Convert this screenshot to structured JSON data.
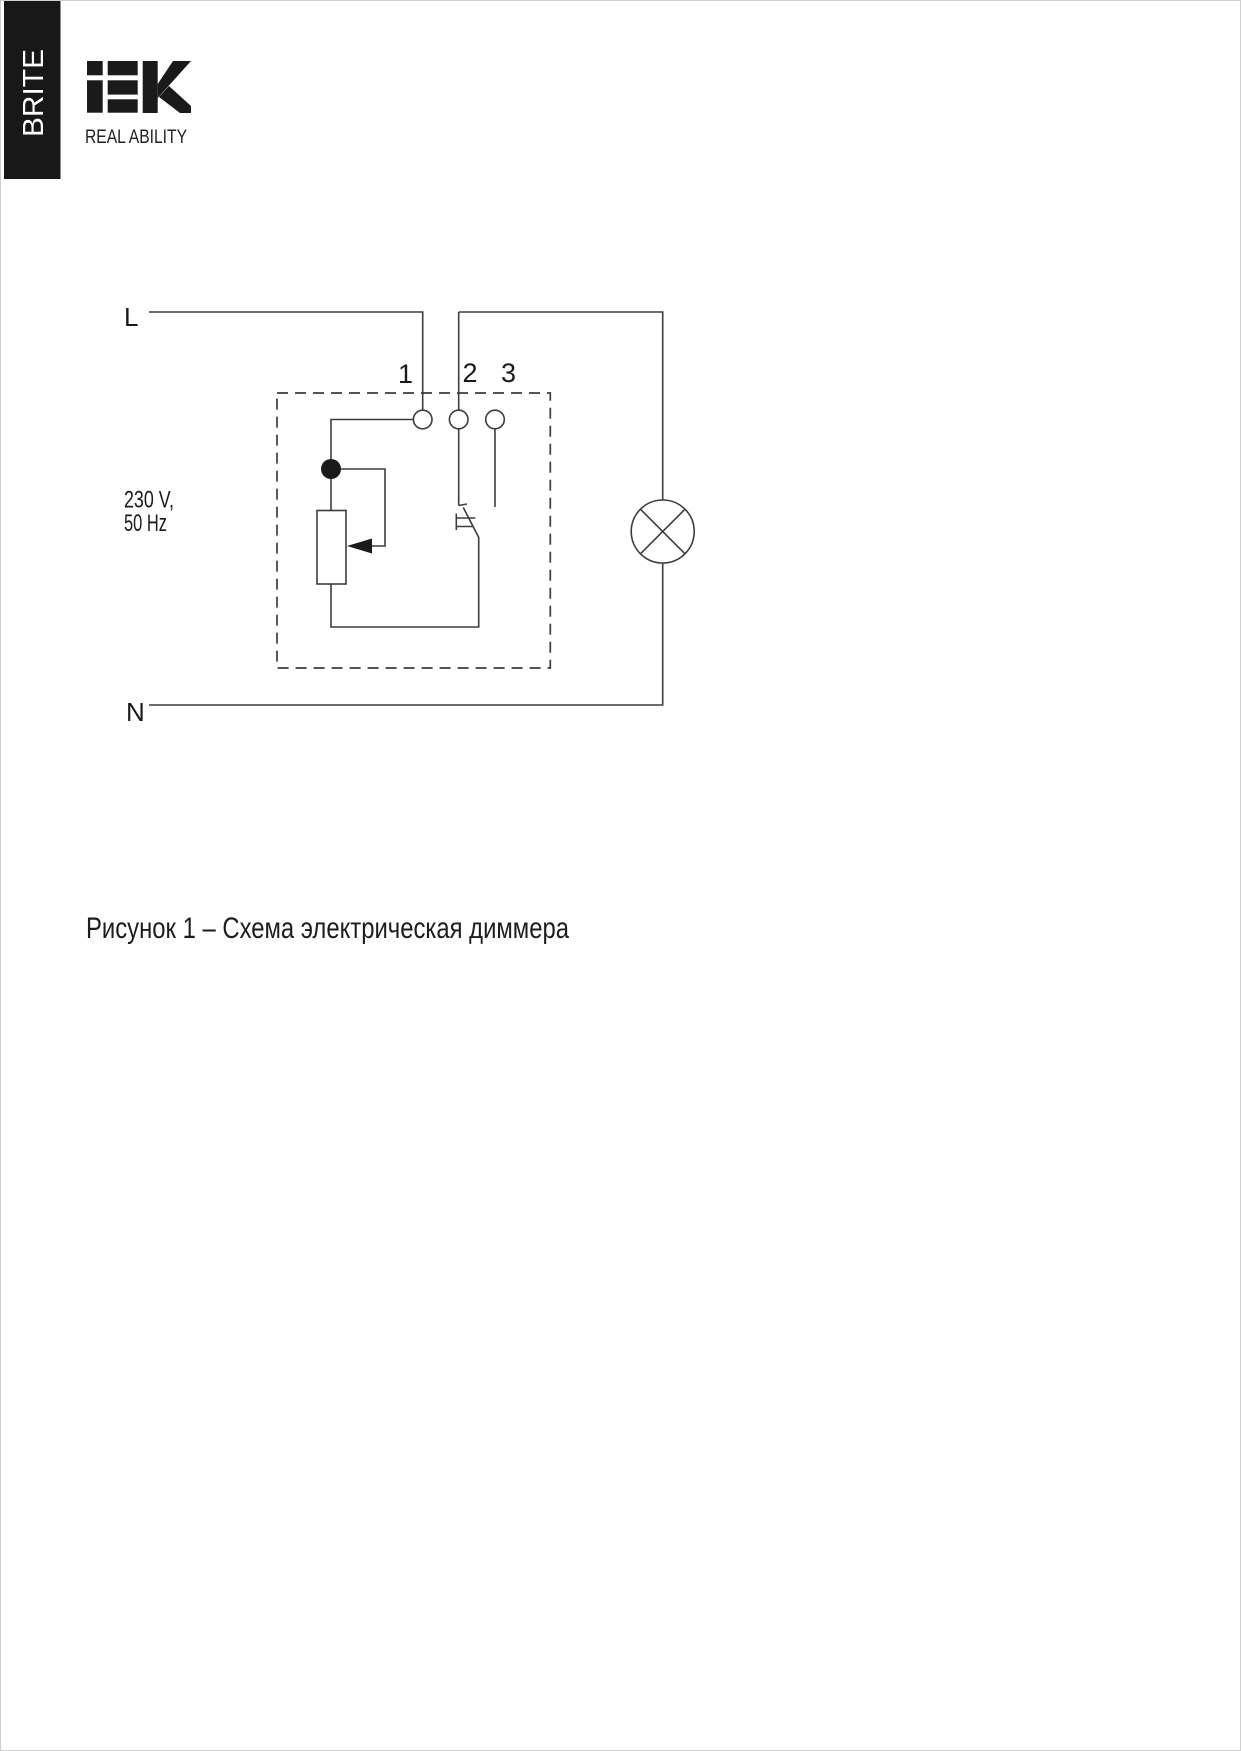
{
  "page": {
    "banner_text": "BRITE",
    "logo_brand": "IEK",
    "logo_tagline": "REAL ABILITY",
    "diagram": {
      "line_label": "L",
      "neutral_label": "N",
      "voltage_line1": "230 V,",
      "voltage_line2": "50 Hz",
      "terminals": [
        "1",
        "2",
        "3"
      ]
    },
    "caption": "Рисунок 1 – Схема электрическая диммера",
    "colors": {
      "line": "#3d3d3d",
      "text": "#1a1a1a",
      "banner_bg": "#181818",
      "banner_text": "#ffffff"
    }
  }
}
